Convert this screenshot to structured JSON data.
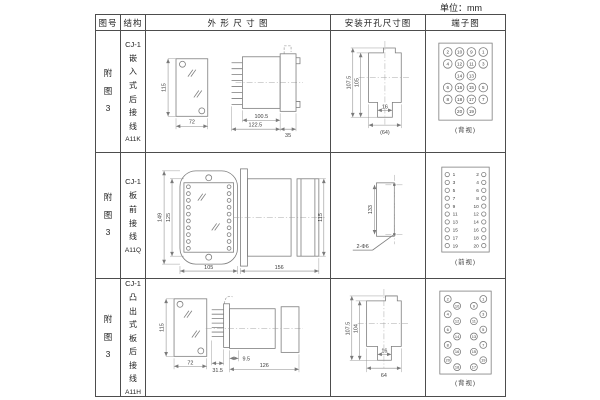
{
  "unit_label": "单位：mm",
  "header": {
    "col_figure": "图号",
    "col_structure": "结构",
    "col_outline": "外 形 尺 寸 图",
    "col_install": "安装开孔尺寸图",
    "col_terminal": "端子图"
  },
  "rows": [
    {
      "figure_no": "附图3",
      "model": "CJ-1",
      "structure": "嵌入式后接线",
      "code": "A11K",
      "dims": {
        "front_h": "115",
        "front_w": "72",
        "len_body": "100.5",
        "len_total": "122.5",
        "flange": "35"
      },
      "install": {
        "h_outer": "107.5",
        "h_inner": "105",
        "notch": "16",
        "width": "(64)"
      },
      "terminal_label": "(背视)"
    },
    {
      "figure_no": "附图3",
      "model": "CJ-1",
      "structure": "板前接线",
      "code": "A11Q",
      "dims": {
        "h_outer": "149",
        "h_inner": "125",
        "front_w": "105",
        "length": "156",
        "side_h": "115"
      },
      "install": {
        "spacing": "133",
        "holes": "2-Φ6"
      },
      "terminal_label": "(前视)"
    },
    {
      "figure_no": "附图3",
      "model": "CJ-1",
      "structure": "凸出式板后接线",
      "code": "A11H",
      "dims": {
        "front_h": "115",
        "front_w": "72",
        "depth": "31.5",
        "offset": "9.5",
        "length": "126"
      },
      "install": {
        "h_outer": "107.5",
        "h_inner": "104",
        "notch": "16",
        "width": "64"
      },
      "terminal_label": "(背视)"
    }
  ],
  "terminals": {
    "grid_back": {
      "rows": [
        [
          "2",
          "10",
          "9",
          "1"
        ],
        [
          "4",
          "12",
          "11",
          "3"
        ],
        [
          "",
          "14",
          "13",
          ""
        ],
        [
          "6",
          "16",
          "15",
          "5"
        ],
        [
          "8",
          "18",
          "17",
          "7"
        ],
        [
          "",
          "20",
          "19",
          ""
        ]
      ]
    },
    "front_list": {
      "pairs": [
        [
          "1",
          "2"
        ],
        [
          "3",
          "4"
        ],
        [
          "5",
          "6"
        ],
        [
          "7",
          "8"
        ],
        [
          "9",
          "10"
        ],
        [
          "11",
          "12"
        ],
        [
          "13",
          "14"
        ],
        [
          "15",
          "16"
        ],
        [
          "17",
          "18"
        ],
        [
          "19",
          "20"
        ]
      ]
    },
    "stagger_back": {
      "left": [
        [
          "2",
          "10"
        ],
        [
          "4",
          "12"
        ],
        [
          "6",
          "14"
        ],
        [
          "8",
          "16"
        ],
        [
          "20",
          "18"
        ]
      ],
      "right": [
        [
          "1",
          "9"
        ],
        [
          "3",
          "11"
        ],
        [
          "5",
          "13"
        ],
        [
          "7",
          "15"
        ],
        [
          "19",
          "17"
        ]
      ]
    }
  }
}
